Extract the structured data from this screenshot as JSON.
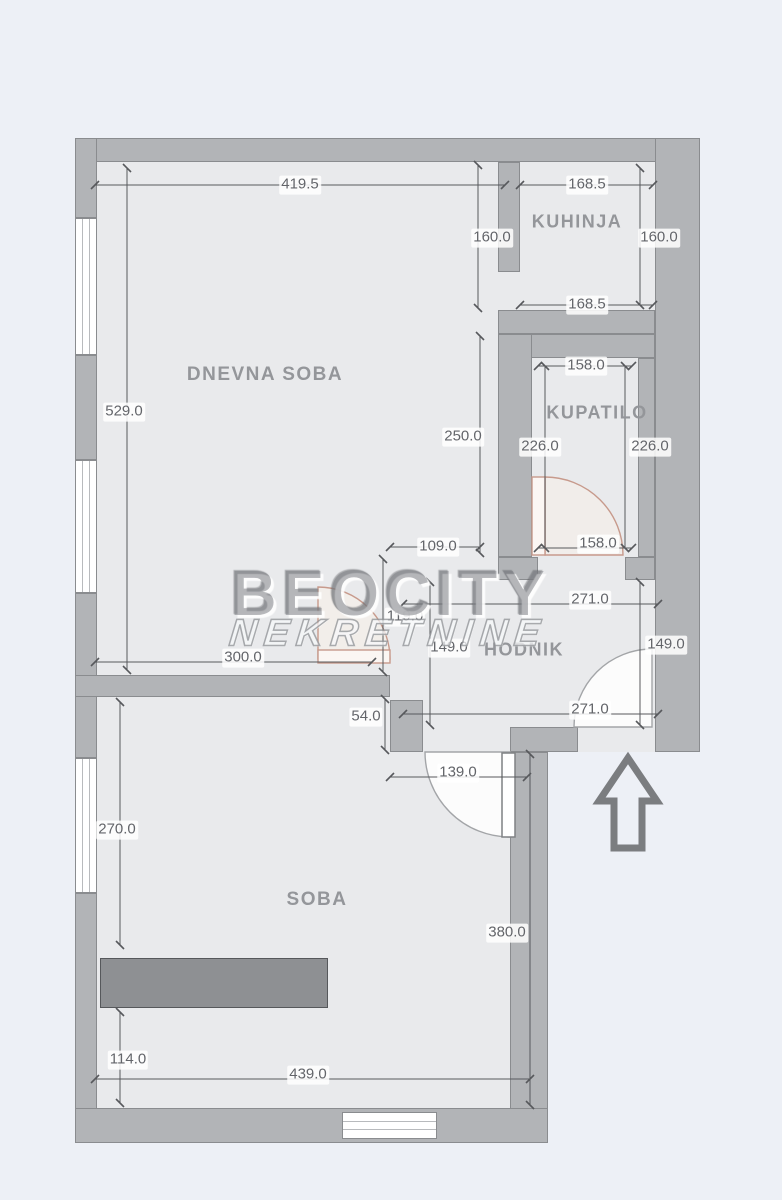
{
  "watermark": {
    "line1": "BEOCITY",
    "line2": "NEKRETNINE"
  },
  "rooms": [
    {
      "name": "DNEVNA SOBA"
    },
    {
      "name": "KUHINJA"
    },
    {
      "name": "KUPATILO"
    },
    {
      "name": "HODNIK"
    },
    {
      "name": "SOBA"
    }
  ],
  "dimensions": [
    {
      "label": "419.5"
    },
    {
      "label": "168.5"
    },
    {
      "label": "160.0"
    },
    {
      "label": "160.0"
    },
    {
      "label": "168.5"
    },
    {
      "label": "529.0"
    },
    {
      "label": "158.0"
    },
    {
      "label": "226.0"
    },
    {
      "label": "226.0"
    },
    {
      "label": "250.0"
    },
    {
      "label": "109.0"
    },
    {
      "label": "158.0"
    },
    {
      "label": "271.0"
    },
    {
      "label": "119.0"
    },
    {
      "label": "300.0"
    },
    {
      "label": "149.0"
    },
    {
      "label": "149.0"
    },
    {
      "label": "271.0"
    },
    {
      "label": "54.0"
    },
    {
      "label": "139.0"
    },
    {
      "label": "270.0"
    },
    {
      "label": "380.0"
    },
    {
      "label": "114.0"
    },
    {
      "label": "439.0"
    }
  ],
  "icons": [
    {
      "name": "entrance-arrow-icon",
      "meaning": "entrance direction"
    }
  ],
  "colors": {
    "background": "#edf0f6",
    "floor": "#e9eaec",
    "wall": "#b2b4b7",
    "wall_outline": "#8a8c8f",
    "dimension_text": "#63656a",
    "room_label": "#94969a",
    "door_accent": "#c79a8c",
    "furniture": "#8e9093"
  }
}
